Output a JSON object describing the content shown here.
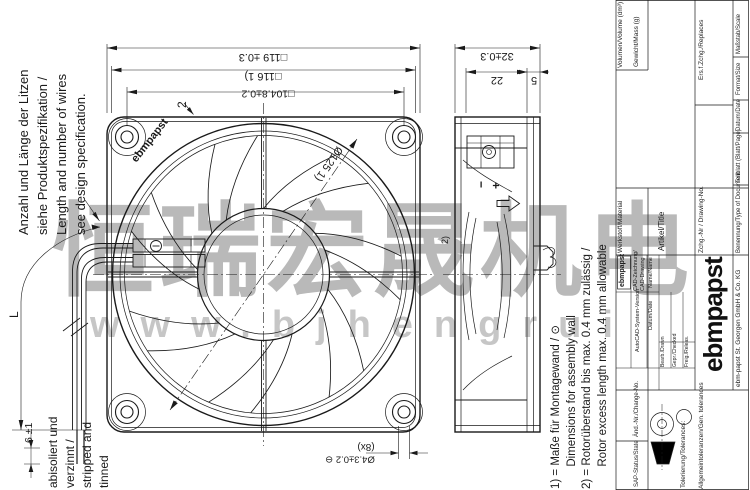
{
  "watermark": {
    "text_cjk": "恒瑞宏晟机电",
    "text_url": "www.bjhengrui"
  },
  "wire_note": {
    "line1": "Anzahl und Länge der Litzen",
    "line2": "siehe Produktspezifikation /",
    "line3": "Length and number of wires",
    "line4": "see design specification."
  },
  "strip_note": {
    "line1": "abisoliert und",
    "line2": "verzinnt /",
    "line3": "stripped and",
    "line4": "tinned"
  },
  "footnotes": {
    "line1": "1) = Maße für Montagewand / ⊙",
    "line2": "       Dimensions for assembly wall",
    "line3": "2) = Rotorüberstand bis max. 0.4 mm zulässig /",
    "line4": "       Rotor excess length max. 0.4 mm allowable"
  },
  "dimensions": {
    "frame": "□119 ±0.3",
    "assembly_frame": "□116 1)",
    "hole_pitch": "□104.8±0.2",
    "depth": "32±0.3",
    "body_depth": "22",
    "flange_depth": "5",
    "cutout": "Ø125 1)",
    "wall": "2",
    "rotor_note_ref": "2)",
    "hole_dia": "Ø4.3±0.2 ⊖",
    "hole_count": "(8x)",
    "lead_length": "L",
    "strip_length": "6 ±1",
    "minus": "−",
    "plus": "+"
  },
  "brand": {
    "hub_logo": "ebmpapst",
    "logo": "ebmpapst",
    "small_logo": "ebmpapst",
    "company": "ebm-papst St. Georgen GmbH & Co. KG"
  },
  "titleblock": {
    "volume": "Volumen/Volume (dm³)",
    "mass": "Gewicht/Mass (g)",
    "scale": "Maßstab/Scale",
    "format": "Format/Size",
    "date": "Datum/Date",
    "sheet": "Teilblatt (Blatt/Page)",
    "doc_type": "Benennung/Type of Document",
    "replaces": "Ers.f.Zchg./Replaces",
    "drawing_no": "Zchg.-Nr / Drawing-No.",
    "material": "Werkstoff/Material",
    "title": "Artikel/Title",
    "cad1": "CAD-Zeichnung/",
    "cad2": "CAD-Drawing",
    "autocad": "AutoCAD-System-Version",
    "name": "Name/Name",
    "date2": "Datum/Date",
    "drawn": "Bearb./Drawn",
    "checked": "Gepr./Checked",
    "released": "Freig./Releas.",
    "change_no": "Änd.-Nr./Change-No.",
    "sap_status": "SAP-Status/State",
    "tolerances": "Tolerierung/Tolerances:",
    "gen_tolerances": "Allgemeintoleranzen/Gen. tolerances"
  }
}
